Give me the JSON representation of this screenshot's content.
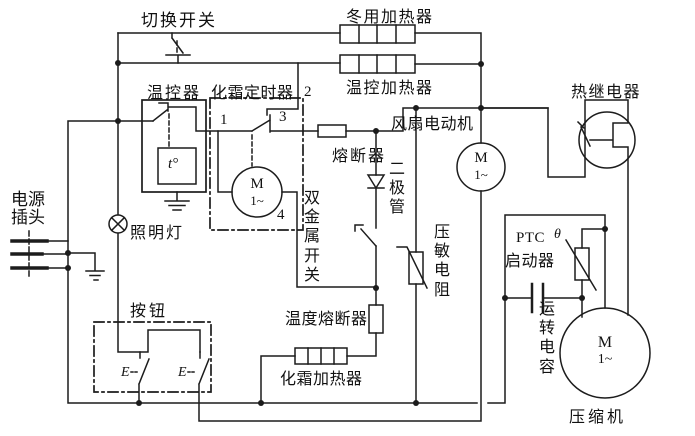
{
  "labels": {
    "switchover_switch": "切换开关",
    "winter_heater": "冬用加热器",
    "thermo_heater": "温控加热器",
    "thermal_relay": "热继电器",
    "thermostat": "温控器",
    "defrost_timer": "化霜定时器",
    "fan_motor": "风扇电动机",
    "fuse": "熔断器",
    "power_plug": "电源插头",
    "lamp": "照明灯",
    "diode": "二极管",
    "bimetal_switch": "双金属开关",
    "varistor": "压敏电阻",
    "ptc_line1": "PTC",
    "ptc_line2": "启动器",
    "run_capacitor": "运转电容",
    "push_button": "按钮",
    "temp_fuse": "温度熔断器",
    "defrost_heater": "化霜加热器",
    "compressor": "压缩机"
  },
  "terminals": {
    "t1": "1",
    "t2": "2",
    "t3": "3",
    "t4": "4"
  },
  "symbols": {
    "motor": "M",
    "phase": "1~",
    "temp_sensor": "t°",
    "theta": "θ",
    "actuator": "E"
  },
  "colors": {
    "wire": "#1c1c1c",
    "background": "#ffffff"
  }
}
